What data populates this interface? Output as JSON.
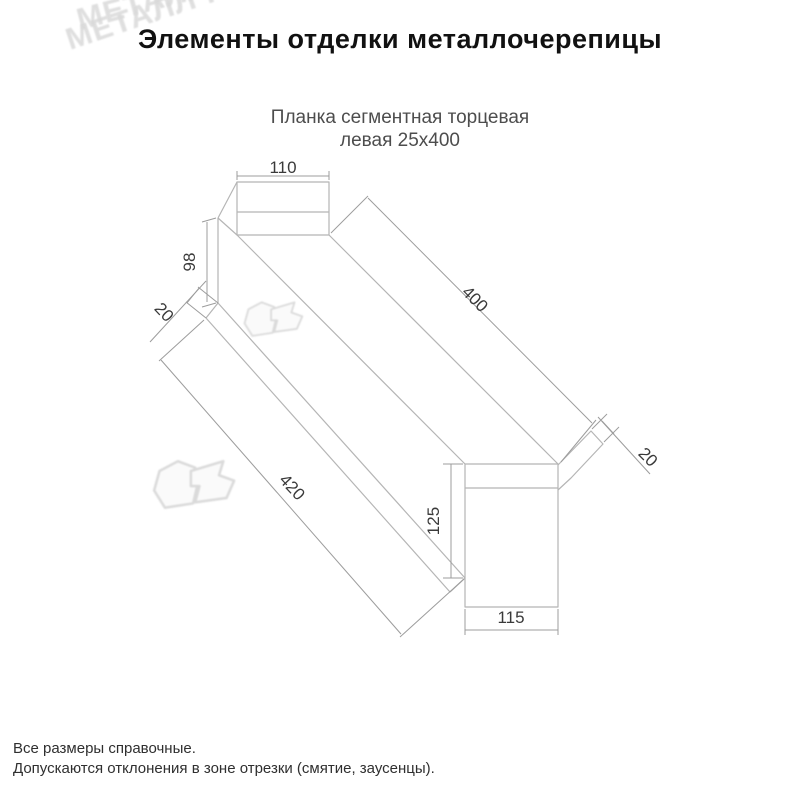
{
  "title": "Элементы отделки металлочерепицы",
  "subtitle": {
    "line1": "Планка сегментная торцевая",
    "line2": "левая 25х400"
  },
  "drawing": {
    "type": "isometric technical drawing of metal end-cap strip",
    "dims": {
      "flange_width_far": "110",
      "face_height_far": "98",
      "hem_far": "20",
      "length_top": "400",
      "length_bottom": "420",
      "face_height_near": "125",
      "face_width_near": "115",
      "hem_near": "20"
    },
    "line_color": "#b5b5b5",
    "dim_color": "#9c9c9c",
    "dim_text_color": "#3a3a3a"
  },
  "watermark": {
    "brand": "МЕТАЛЛ ПРОФИЛЬ",
    "color": "#d9d9d9"
  },
  "footer": {
    "line1": "Все размеры справочные.",
    "line2": "Допускаются отклонения в зоне отрезки (смятие, заусенцы)."
  }
}
